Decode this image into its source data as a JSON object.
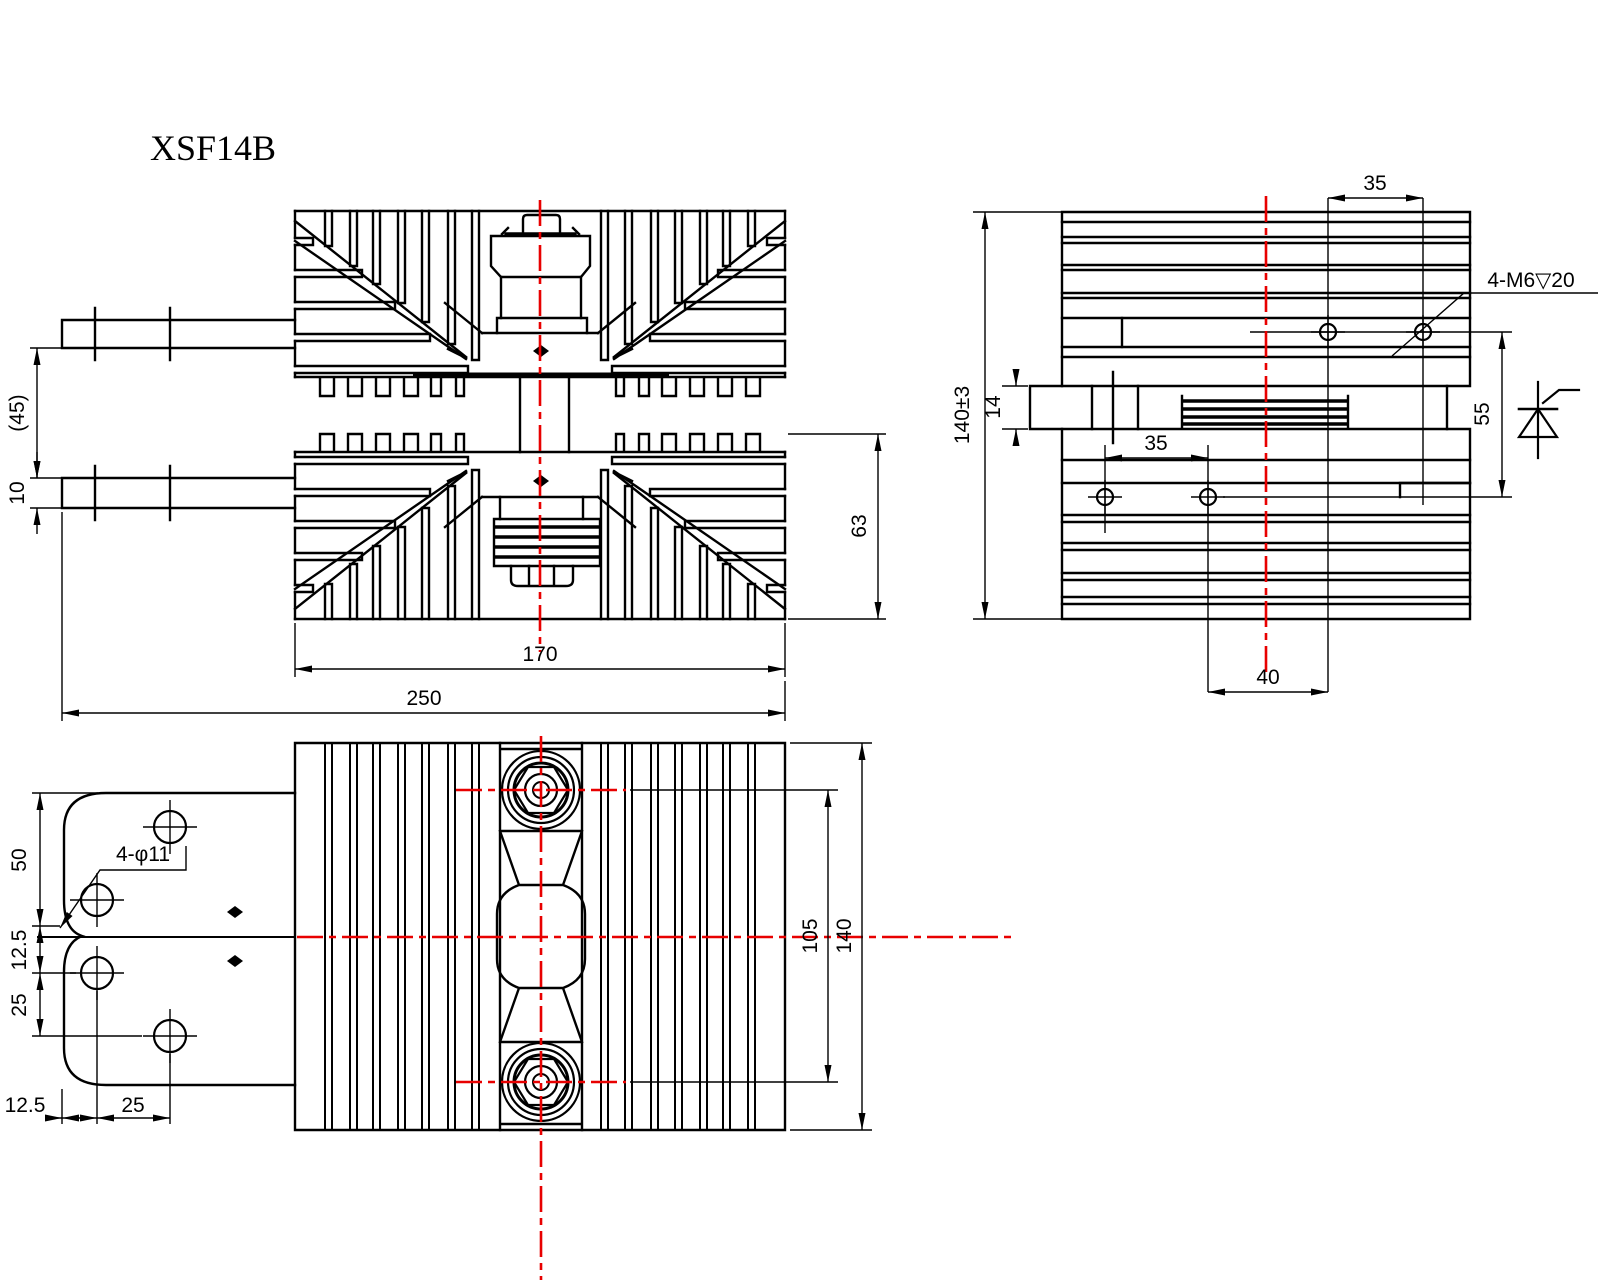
{
  "title": "XSF14B",
  "colors": {
    "line": "#000000",
    "centerline": "#e80000",
    "background": "#ffffff"
  },
  "front_view": {
    "dim_tab_gap": "(45)",
    "dim_tab_thickness": "10",
    "dim_fin_width": "170",
    "dim_overall_width": "250",
    "dim_half_height": "63"
  },
  "side_view": {
    "dim_hole_spacing_top": "35",
    "dim_overall_height": "140±3",
    "dim_plate_thickness": "14",
    "dim_hole_spacing_bottom": "35",
    "dim_hole_height": "55",
    "dim_center_offset": "40",
    "label_tapped_holes": "4-M6▽20"
  },
  "bottom_view": {
    "label_bracket_holes": "4-φ11",
    "dim_bracket_top": "50",
    "dim_bracket_mid": "12.5",
    "dim_bracket_low": "25",
    "dim_bracket_left": "12.5",
    "dim_bracket_hole_x": "25",
    "dim_stud_spacing": "105",
    "dim_body_height": "140"
  }
}
